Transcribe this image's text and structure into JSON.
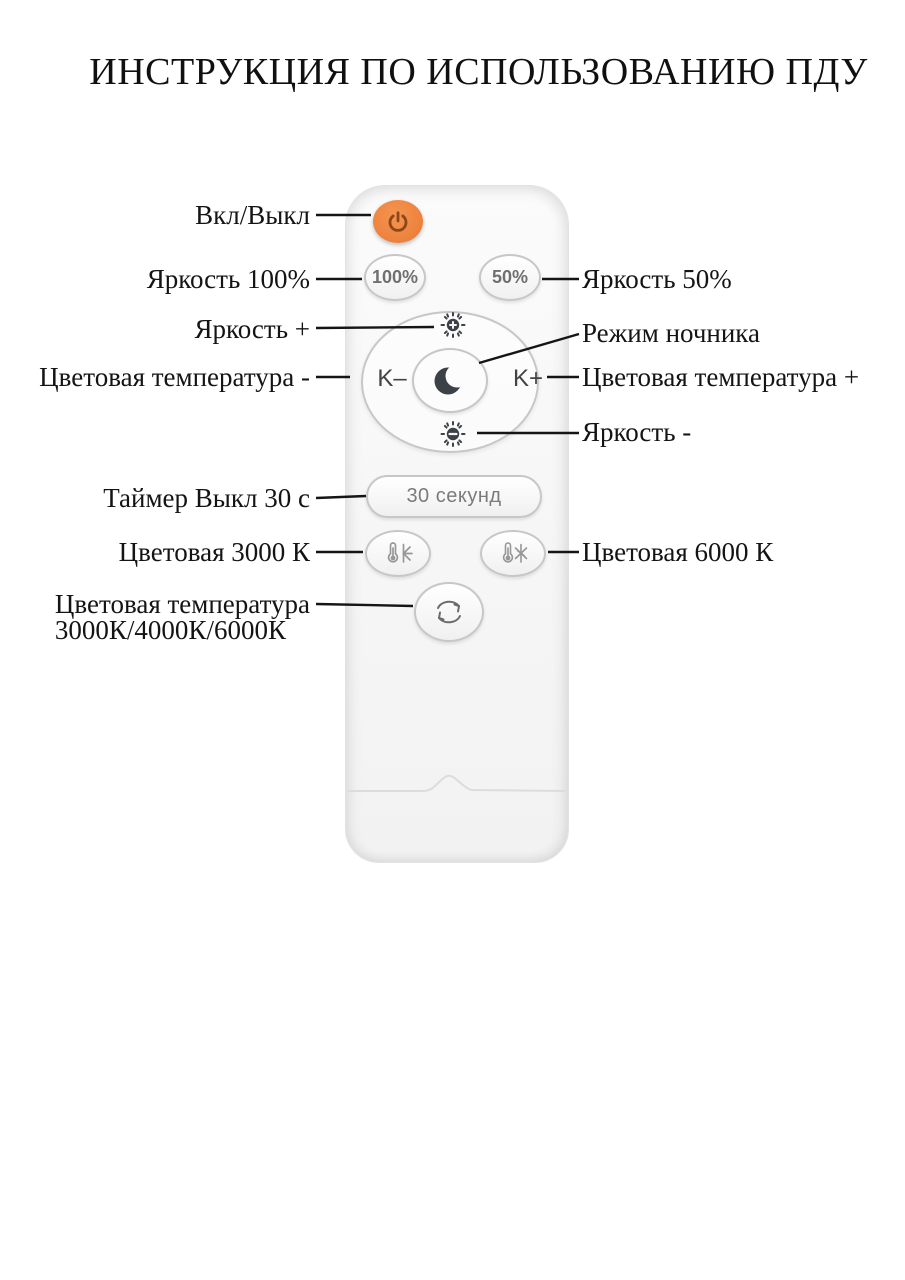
{
  "title": "ИНСТРУКЦИЯ ПО ИСПОЛЬЗОВАНИЮ ПДУ",
  "labels": {
    "power": "Вкл/Выкл",
    "brightness_100": "Яркость 100%",
    "brightness_50": "Яркость 50%",
    "brightness_up": "Яркость +",
    "night_mode": "Режим ночника",
    "color_temp_minus": "Цветовая температура -",
    "color_temp_plus": "Цветовая температура +",
    "brightness_down": "Яркость -",
    "timer_off_30s": "Таймер Выкл 30 с",
    "color_3000": "Цветовая 3000 К",
    "color_6000": "Цветовая 6000 К",
    "color_cycle_line1": "Цветовая температура",
    "color_cycle_line2": "3000К/4000К/6000К"
  },
  "remote": {
    "buttons": {
      "brightness_100": "100%",
      "brightness_50": "50%",
      "timer": "30 секунд",
      "k_minus": "K–",
      "k_plus": "K+"
    },
    "icons": {
      "power": "power-icon",
      "brightness_up": "sun-plus-icon",
      "brightness_down": "sun-minus-icon",
      "night_mode": "moon-icon",
      "warm": "thermometer-sun-icon",
      "cold": "thermometer-snowflake-icon",
      "cycle": "cycle-arrows-icon"
    }
  },
  "colors": {
    "power_button_fill": "#ee8440",
    "power_icon": "#8d4718",
    "button_border": "#c7c7c7",
    "button_text": "#6f6f6f",
    "dark_icon": "#3c4047",
    "label_text": "#141414",
    "thermo_icon": "#979797",
    "cycle_icon": "#6b6b6b"
  }
}
